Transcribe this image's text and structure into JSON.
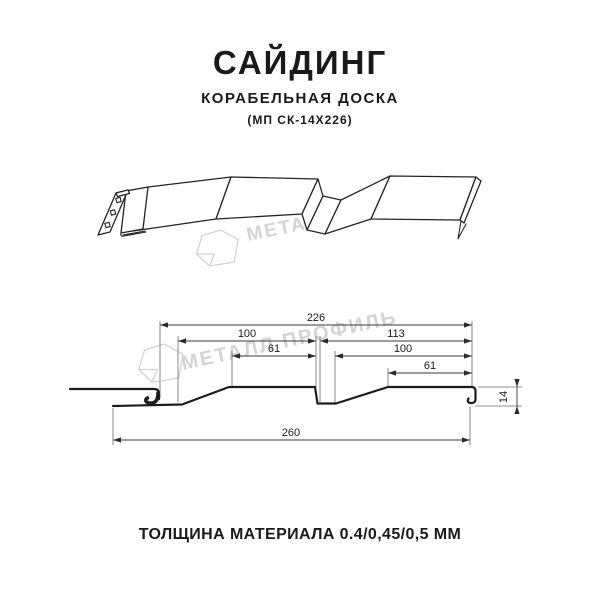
{
  "header": {
    "title": "САЙДИНГ",
    "subtitle": "КОРАБЕЛЬНАЯ ДОСКА",
    "model": "(МП СК-14Х226)"
  },
  "watermark": {
    "text": "МЕТАЛЛ ПРОФИЛЬ",
    "color": "#d4d4d4"
  },
  "diagram": {
    "dim_overall": "226",
    "dim_left_outer": "100",
    "dim_left_inner": "61",
    "dim_right_outer": "113",
    "dim_right_mid": "100",
    "dim_right_inner": "61",
    "dim_total": "260",
    "dim_height": "14",
    "units": "мм"
  },
  "footer": {
    "caption": "ТОЛЩИНА МАТЕРИАЛА 0.4/0,45/0,5 ММ"
  },
  "colors": {
    "line": "#1c1c1c",
    "dimension": "#3a3a3a",
    "watermark": "#d4d4d4",
    "background": "#ffffff"
  }
}
